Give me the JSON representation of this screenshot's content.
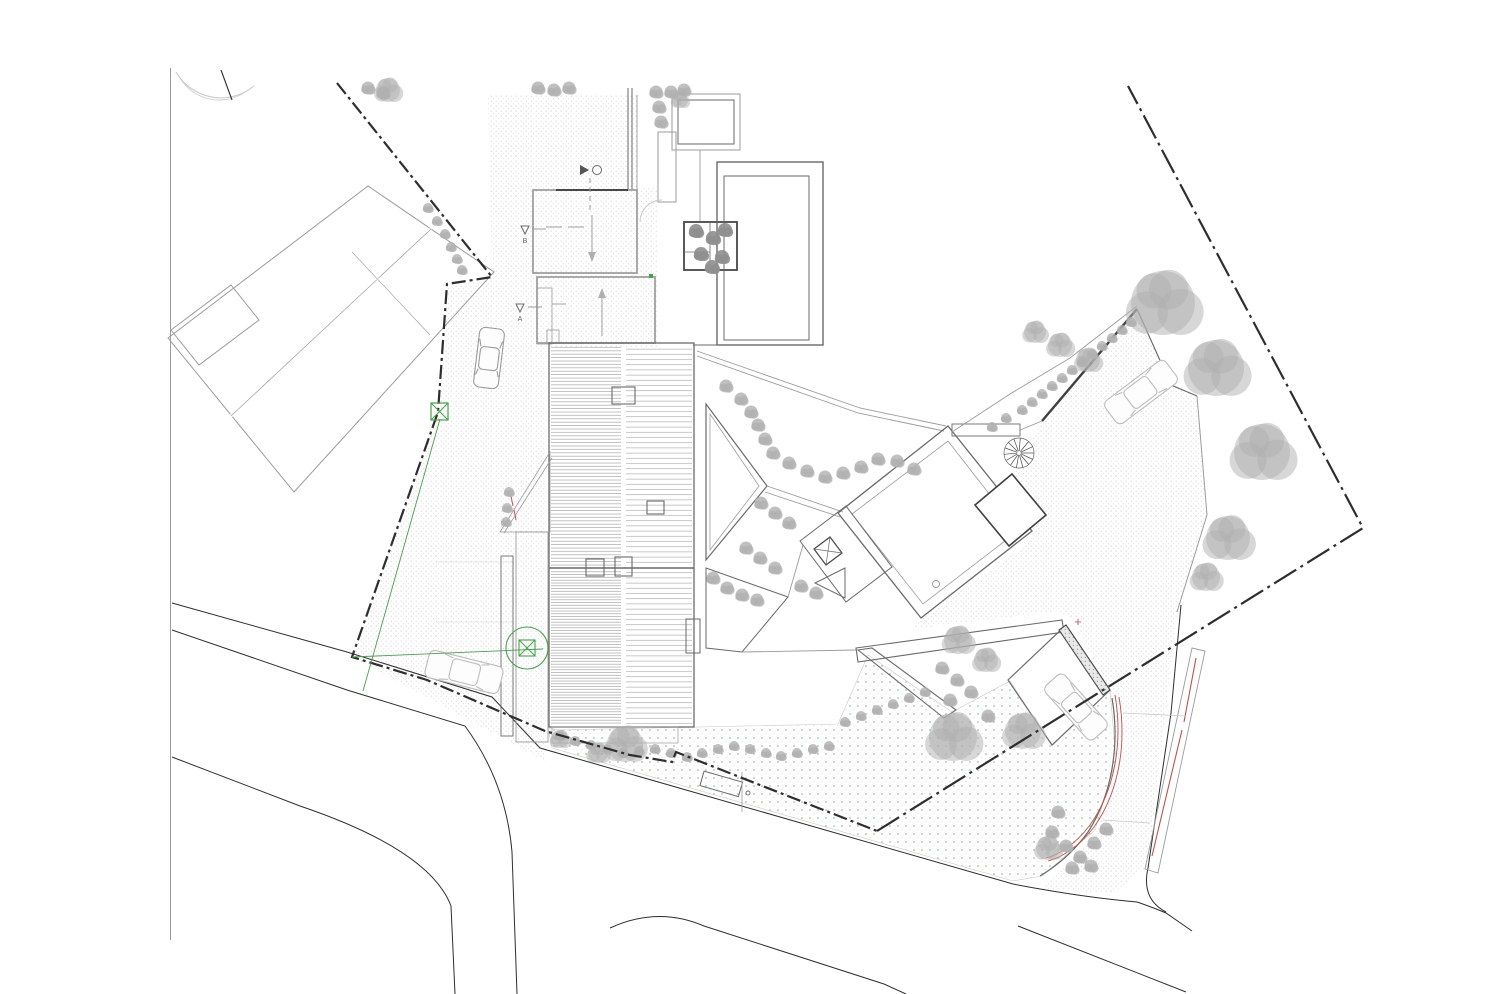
{
  "document": {
    "kind": "architectural-site-plan",
    "view": "roof / site plan, no visible title block",
    "background": "#ffffff"
  },
  "palette": {
    "paper": "#ffffff",
    "ink_strong": "#2e2e2e",
    "ink_mid": "#6a6a6a",
    "ink_light": "#9b9b9b",
    "ink_faint": "#c9c9c9",
    "survey_green": "#46a24a",
    "accent_red": "#c2504d",
    "lawn_dot": "#95c295",
    "stipple_dot": "#c8c8c8",
    "tree_gray": "#b0b0b0",
    "tree_dark": "#8f8f8f",
    "car_gray": "#9a9a9a",
    "car_light": "#bdbdbd"
  },
  "annotations": {
    "section_a": "A",
    "section_b": "B"
  },
  "features": {
    "trees_large": [
      [
        1163,
        303,
        32
      ],
      [
        1216,
        368,
        28
      ],
      [
        1262,
        452,
        28
      ],
      [
        1228,
        538,
        22
      ],
      [
        1206,
        577,
        14
      ],
      [
        1088,
        360,
        12
      ],
      [
        1060,
        345,
        12
      ],
      [
        1035,
        332,
        11
      ],
      [
        953,
        737,
        24
      ],
      [
        1023,
        731,
        18
      ],
      [
        958,
        640,
        14
      ],
      [
        986,
        660,
        12
      ],
      [
        625,
        744,
        18
      ],
      [
        598,
        753,
        10
      ],
      [
        560,
        739,
        9
      ],
      [
        1048,
        848,
        12
      ],
      [
        388,
        90,
        12
      ],
      [
        680,
        100,
        8
      ]
    ],
    "trees_small": [
      [
        538,
        88
      ],
      [
        554,
        90
      ],
      [
        569,
        88
      ],
      [
        656,
        92
      ],
      [
        671,
        92
      ],
      [
        684,
        90
      ],
      [
        659,
        107
      ],
      [
        661,
        122
      ],
      [
        368,
        88
      ],
      [
        383,
        93
      ],
      [
        428,
        208,
        5
      ],
      [
        437,
        221,
        5
      ],
      [
        445,
        234,
        5
      ],
      [
        451,
        247,
        5
      ],
      [
        457,
        259,
        5
      ],
      [
        462,
        270,
        5
      ],
      [
        726,
        386
      ],
      [
        741,
        399
      ],
      [
        751,
        412
      ],
      [
        758,
        425
      ],
      [
        765,
        439
      ],
      [
        773,
        453
      ],
      [
        789,
        463
      ],
      [
        807,
        471
      ],
      [
        825,
        477
      ],
      [
        843,
        473
      ],
      [
        861,
        467
      ],
      [
        878,
        459
      ],
      [
        897,
        461
      ],
      [
        914,
        469
      ],
      [
        761,
        503
      ],
      [
        775,
        513
      ],
      [
        789,
        523
      ],
      [
        746,
        548
      ],
      [
        760,
        558
      ],
      [
        775,
        568
      ],
      [
        713,
        578
      ],
      [
        727,
        588
      ],
      [
        742,
        595
      ],
      [
        757,
        600
      ],
      [
        801,
        586
      ],
      [
        816,
        593
      ],
      [
        560,
        736,
        5
      ],
      [
        575,
        741,
        5
      ],
      [
        591,
        745,
        5
      ],
      [
        607,
        749,
        5
      ],
      [
        623,
        753,
        5
      ],
      [
        639,
        751,
        5
      ],
      [
        655,
        749,
        5
      ],
      [
        671,
        753,
        5
      ],
      [
        687,
        757,
        5
      ],
      [
        702,
        753,
        5
      ],
      [
        718,
        749,
        5
      ],
      [
        734,
        746,
        5
      ],
      [
        750,
        749,
        5
      ],
      [
        766,
        753,
        5
      ],
      [
        781,
        756,
        5
      ],
      [
        797,
        753,
        5
      ],
      [
        813,
        749,
        5
      ],
      [
        829,
        746,
        5
      ],
      [
        845,
        722,
        5
      ],
      [
        861,
        716,
        5
      ],
      [
        877,
        710,
        5
      ],
      [
        893,
        704,
        5
      ],
      [
        909,
        698,
        5
      ],
      [
        925,
        692,
        5
      ],
      [
        942,
        668
      ],
      [
        957,
        680
      ],
      [
        971,
        692
      ],
      [
        950,
        700
      ],
      [
        988,
        716
      ],
      [
        1052,
        832
      ],
      [
        1066,
        846
      ],
      [
        1080,
        857
      ],
      [
        1094,
        843
      ],
      [
        1106,
        829
      ],
      [
        1072,
        868
      ],
      [
        1091,
        866
      ],
      [
        1058,
        812
      ],
      [
        509,
        492,
        5
      ],
      [
        507,
        508,
        5
      ],
      [
        506,
        522,
        5
      ],
      [
        1022,
        410,
        5
      ],
      [
        1032,
        402,
        5
      ],
      [
        1042,
        394,
        5
      ],
      [
        1052,
        386,
        5
      ],
      [
        1062,
        378,
        5
      ],
      [
        1072,
        370,
        5
      ],
      [
        1082,
        362,
        5
      ],
      [
        1092,
        354,
        5
      ],
      [
        1102,
        346,
        5
      ],
      [
        1112,
        338,
        5
      ],
      [
        1122,
        330,
        5
      ],
      [
        1131,
        322,
        5
      ],
      [
        992,
        427,
        5
      ],
      [
        1006,
        418,
        5
      ]
    ],
    "planter_trees": [
      [
        696,
        231
      ],
      [
        713,
        238
      ],
      [
        725,
        230
      ],
      [
        701,
        254
      ],
      [
        722,
        257
      ],
      [
        712,
        267
      ]
    ],
    "cars": [
      {
        "x": 489,
        "y": 358,
        "angle": 97,
        "len": 60,
        "wid": 25,
        "tone": "mid",
        "name": "car-northwest-drive"
      },
      {
        "x": 464,
        "y": 672,
        "angle": 14,
        "len": 76,
        "wid": 28,
        "tone": "light",
        "name": "car-street-parking"
      },
      {
        "x": 1141,
        "y": 392,
        "angle": 143,
        "len": 76,
        "wid": 28,
        "tone": "light",
        "name": "car-east-terrace"
      },
      {
        "x": 1076,
        "y": 707,
        "angle": 48,
        "len": 72,
        "wid": 26,
        "tone": "light",
        "name": "car-carport"
      }
    ],
    "spiral_stair": {
      "x": 1019,
      "y": 453,
      "r": 15
    },
    "survey_points": {
      "box_marker": [
        440,
        412
      ],
      "circle_marker": [
        527,
        648
      ]
    },
    "skylight_grate": {
      "x": 672,
      "y": 94,
      "w": 68,
      "h": 56
    }
  }
}
